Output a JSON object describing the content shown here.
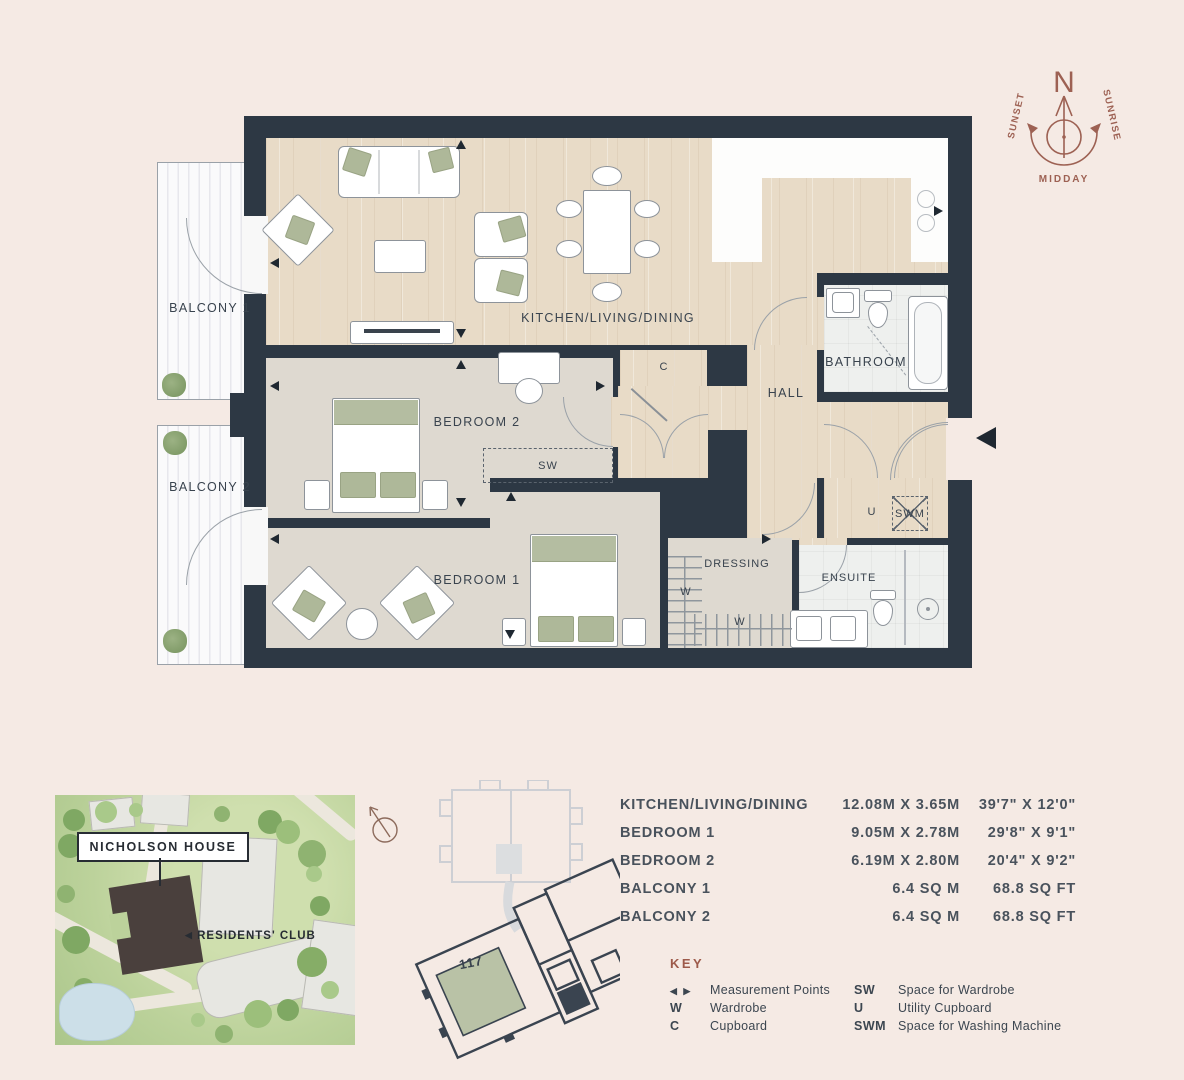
{
  "colors": {
    "background": "#f5eae4",
    "wall": "#2d3844",
    "terracotta_accent": "#9d5a4a",
    "sage_highlight": "#b9c2a6",
    "wood_floor": "#e8dbc7",
    "carpet_floor": "#ded9d0"
  },
  "compass": {
    "north": "N",
    "sunset": "SUNSET",
    "sunrise": "SUNRISE",
    "midday": "MIDDAY"
  },
  "floorplan": {
    "rooms": {
      "balcony1": "BALCONY 1",
      "balcony2": "BALCONY 2",
      "kitchen_living_dining": "KITCHEN/LIVING/DINING",
      "bedroom2": "BEDROOM 2",
      "bedroom1": "BEDROOM 1",
      "hall": "HALL",
      "bathroom": "BATHROOM",
      "dressing": "DRESSING",
      "ensuite": "ENSUITE"
    },
    "markers": {
      "sw": "SW",
      "c": "C",
      "u": "U",
      "swm": "SWM",
      "w_left": "W",
      "w_bottom": "W"
    }
  },
  "site_map": {
    "building_label": "NICHOLSON HOUSE",
    "club_arrow": "◀",
    "club_label": "RESIDENTS' CLUB"
  },
  "key_plan": {
    "unit": "117"
  },
  "dimensions": {
    "rows": [
      {
        "name": "KITCHEN/LIVING/DINING",
        "metric": "12.08M X 3.65M",
        "imperial": "39'7\" X 12'0\""
      },
      {
        "name": "BEDROOM 1",
        "metric": "9.05M X 2.78M",
        "imperial": "29'8\" X 9'1\""
      },
      {
        "name": "BEDROOM 2",
        "metric": "6.19M X 2.80M",
        "imperial": "20'4\" X 9'2\""
      },
      {
        "name": "BALCONY 1",
        "metric": "6.4 SQ M",
        "imperial": "68.8 SQ FT"
      },
      {
        "name": "BALCONY 2",
        "metric": "6.4 SQ M",
        "imperial": "68.8 SQ FT"
      }
    ]
  },
  "key": {
    "title": "KEY",
    "column1": [
      {
        "symbol": "◀ ▶",
        "label": "Measurement Points"
      },
      {
        "symbol": "W",
        "label": "Wardrobe"
      },
      {
        "symbol": "C",
        "label": "Cupboard"
      }
    ],
    "column2": [
      {
        "symbol": "SW",
        "label": "Space for Wardrobe"
      },
      {
        "symbol": "U",
        "label": "Utility Cupboard"
      },
      {
        "symbol": "SWM",
        "label": "Space for Washing Machine"
      }
    ]
  }
}
